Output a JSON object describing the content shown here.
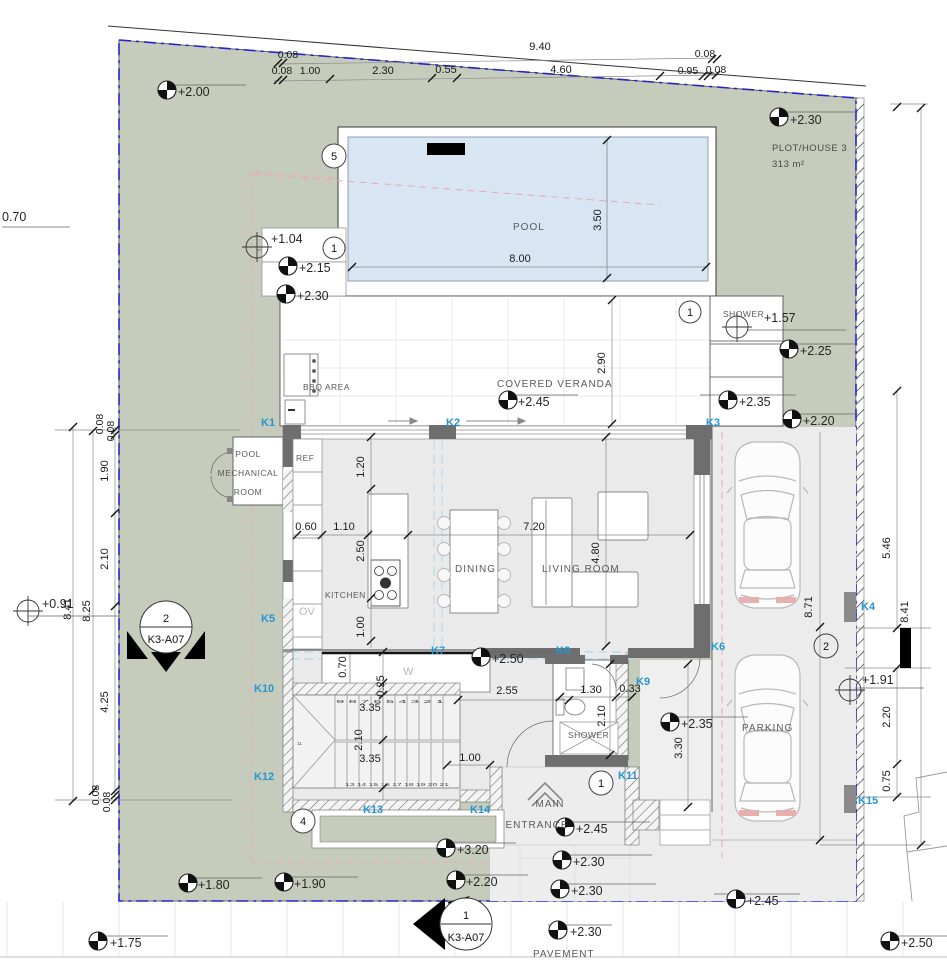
{
  "plot": {
    "name": "PLOT/HOUSE 3",
    "area": "313 m²"
  },
  "rooms": {
    "pool": "POOL",
    "bbq": "BBQ AREA",
    "veranda": "COVERED VERANDA",
    "outdoor_shower": "SHOWER",
    "pool_mech_1": "POOL",
    "pool_mech_2": "MECHANICAL",
    "pool_mech_3": "ROOM",
    "fridge": "REF",
    "oven": "OV",
    "kitchen": "KITCHEN",
    "dining": "DINING",
    "living": "LIVING ROOM",
    "washer": "W",
    "wc_shower": "SHOWER",
    "main_entrance_1": "MAIN",
    "main_entrance_2": "ENTRANCE",
    "parking": "PARKING",
    "pavement": "PAVEMENT"
  },
  "axes": [
    "K1",
    "K2",
    "K3",
    "K4",
    "K5",
    "K6",
    "K7",
    "K8",
    "K9",
    "K10",
    "K11",
    "K12",
    "K13",
    "K14",
    "K15"
  ],
  "levels": [
    "+2.00",
    "+2.30",
    "+1.04",
    "+2.15",
    "+2.30",
    "+2.45",
    "+1.57",
    "+2.25",
    "+2.35",
    "+2.20",
    "+0.91",
    "+2.50",
    "+2.35",
    "+1.91",
    "+3.20",
    "+2.45",
    "+2.30",
    "+2.30",
    "+1.80",
    "+1.90",
    "+2.20",
    "+2.45",
    "+2.30",
    "+1.75",
    "+2.50",
    "0.70"
  ],
  "dims": {
    "top_row1": [
      "0.08",
      "9.40",
      "0.08"
    ],
    "top_row2": [
      "0.08",
      "1.00",
      "2.30",
      "0.55",
      "4.60",
      "0.95",
      "0.08"
    ],
    "left": [
      "0.08",
      "0.08",
      "1.90",
      "2.10",
      "4.25",
      "0.08",
      "0.08",
      "8.25",
      "8.41"
    ],
    "right": [
      "5.46",
      "8.41",
      "2.20",
      "0.75",
      "8.71"
    ],
    "pool": [
      "8.00",
      "3.50"
    ],
    "veranda": [
      "2.90"
    ],
    "interior": [
      "1.20",
      "0.60",
      "1.10",
      "2.50",
      "7.20",
      "4.80",
      "1.00",
      "0.70",
      "0.25",
      "3.35",
      "2.10",
      "3.35",
      "1.00",
      "2.55",
      "1.30",
      "0.33",
      "2.10",
      "3.30"
    ]
  },
  "stairs": {
    "top_run": "9 8 7 6 5 4 3 2 1",
    "winder": "11",
    "bottom_run": "13 14 15 16 17 18 19 20 21"
  },
  "markers": {
    "n5": "5",
    "n1": "1",
    "n2": "2",
    "n4": "4",
    "section": "K3-A07"
  },
  "colors": {
    "plot_green": "#c6ccbb",
    "pool_water": "#d8e6f3",
    "floor_gray": "#eaeaea",
    "wall_gray": "#6e6e6e",
    "axis_blue": "#2596d1",
    "boundary_blue": "#2323cf",
    "setback_pink": "#eca6ba"
  }
}
